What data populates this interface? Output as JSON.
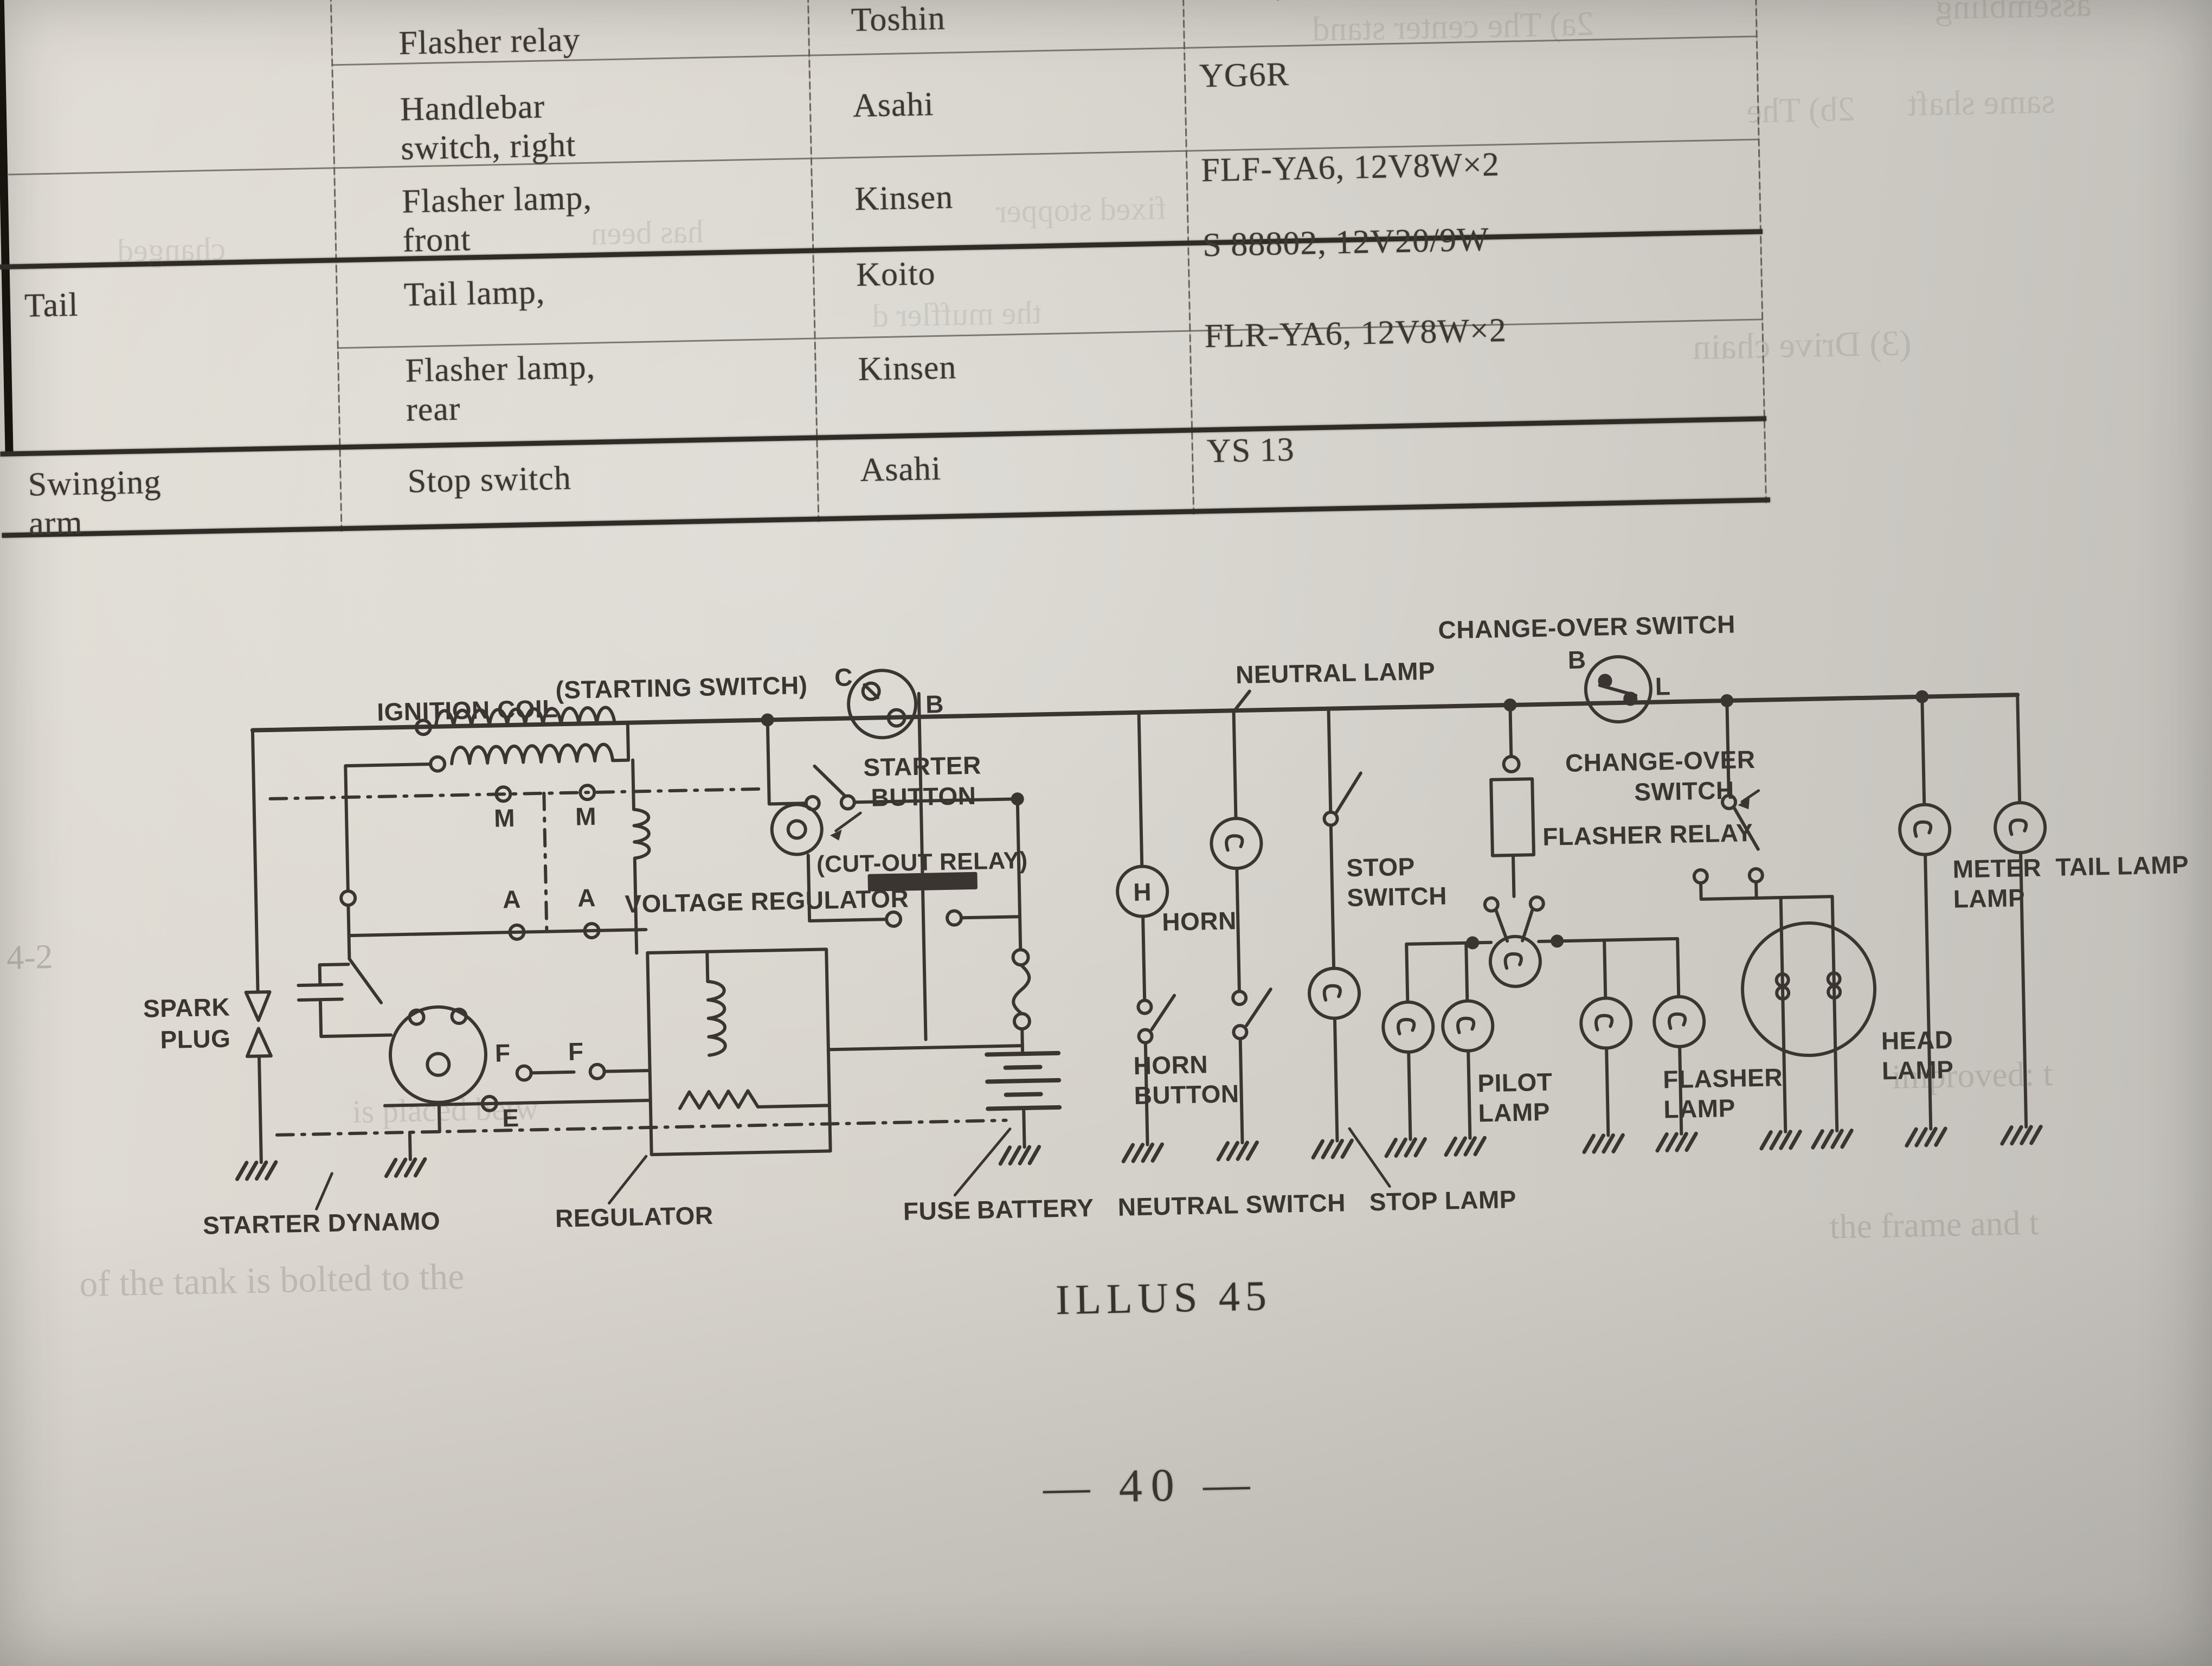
{
  "page": {
    "caption": "ILLUS 45",
    "page_number": "— 40 —",
    "paper_color": "#d6d2cb",
    "ink_color": "#3a3530"
  },
  "table": {
    "rows": [
      {
        "group_lines": [],
        "component_lines": [
          "Flasher relay"
        ],
        "maker": "Toshin",
        "type": "121 4,"
      },
      {
        "group_lines": [],
        "component_lines": [
          "Handlebar",
          "switch, right"
        ],
        "maker": "Asahi",
        "type": "YG6R"
      },
      {
        "group_lines": [],
        "component_lines": [
          "Flasher lamp,",
          "front"
        ],
        "maker": "Kinsen",
        "type": "FLF-YA6, 12V8W×2"
      },
      {
        "group_lines": [
          "Tail"
        ],
        "component_lines": [
          "Tail lamp,"
        ],
        "maker": "Koito",
        "type": "S 88802, 12V20/9W"
      },
      {
        "group_lines": [],
        "component_lines": [
          "Flasher lamp,",
          "rear"
        ],
        "maker": "Kinsen",
        "type": "FLR-YA6, 12V8W×2"
      },
      {
        "group_lines": [
          "Swinging",
          "arm"
        ],
        "component_lines": [
          "Stop switch"
        ],
        "maker": "Asahi",
        "type": "YS 13"
      }
    ]
  },
  "ghosts": [
    "2a) The center stand",
    "assembling",
    "2b) The",
    "same shaft",
    "has been",
    "changed",
    "fixed stopper",
    "the muffler d",
    "(3) Drive chain",
    "improved: t",
    "the frame and t",
    "of the tank is bolted to the",
    "is placed betw",
    "4-2"
  ],
  "diagram": {
    "labels": {
      "ignition_coil": "IGNITION COIL",
      "starting_switch": "(STARTING SWITCH)",
      "starter_button_1": "STARTER",
      "starter_button_2": "BUTTON",
      "cut_out_relay": "(CUT-OUT RELAY)",
      "neutral_lamp": "NEUTRAL LAMP",
      "change_over_switch": "CHANGE-OVER SWITCH",
      "change_over_2_1": "CHANGE-OVER",
      "change_over_2_2": "SWITCH",
      "flasher_relay": "FLASHER RELAY",
      "meter_lamp_1": "METER",
      "meter_lamp_2": "LAMP",
      "tail_lamp": "TAIL LAMP",
      "spark_plug_1": "SPARK",
      "spark_plug_2": "PLUG",
      "voltage_regulator": "VOLTAGE REGULATOR",
      "horn": "HORN",
      "stop_switch_1": "STOP",
      "stop_switch_2": "SWITCH",
      "horn_button_1": "HORN",
      "horn_button_2": "BUTTON",
      "pilot_lamp_1": "PILOT",
      "pilot_lamp_2": "LAMP",
      "flasher_lamp_1": "FLASHER",
      "flasher_lamp_2": "LAMP",
      "head_lamp_1": "HEAD",
      "head_lamp_2": "LAMP",
      "starter_dynamo": "STARTER DYNAMO",
      "regulator": "REGULATOR"
    },
    "bottom_labels": [
      "FUSE",
      "BATTERY",
      "NEUTRAL SWITCH",
      "STOP LAMP"
    ],
    "terminals": {
      "c": "C",
      "b": "B",
      "co_b": "B",
      "co_l": "L",
      "m1": "M",
      "m2": "M",
      "a1": "A",
      "a2": "A",
      "f1": "F",
      "f2": "F",
      "e": "E",
      "h": "H"
    }
  }
}
